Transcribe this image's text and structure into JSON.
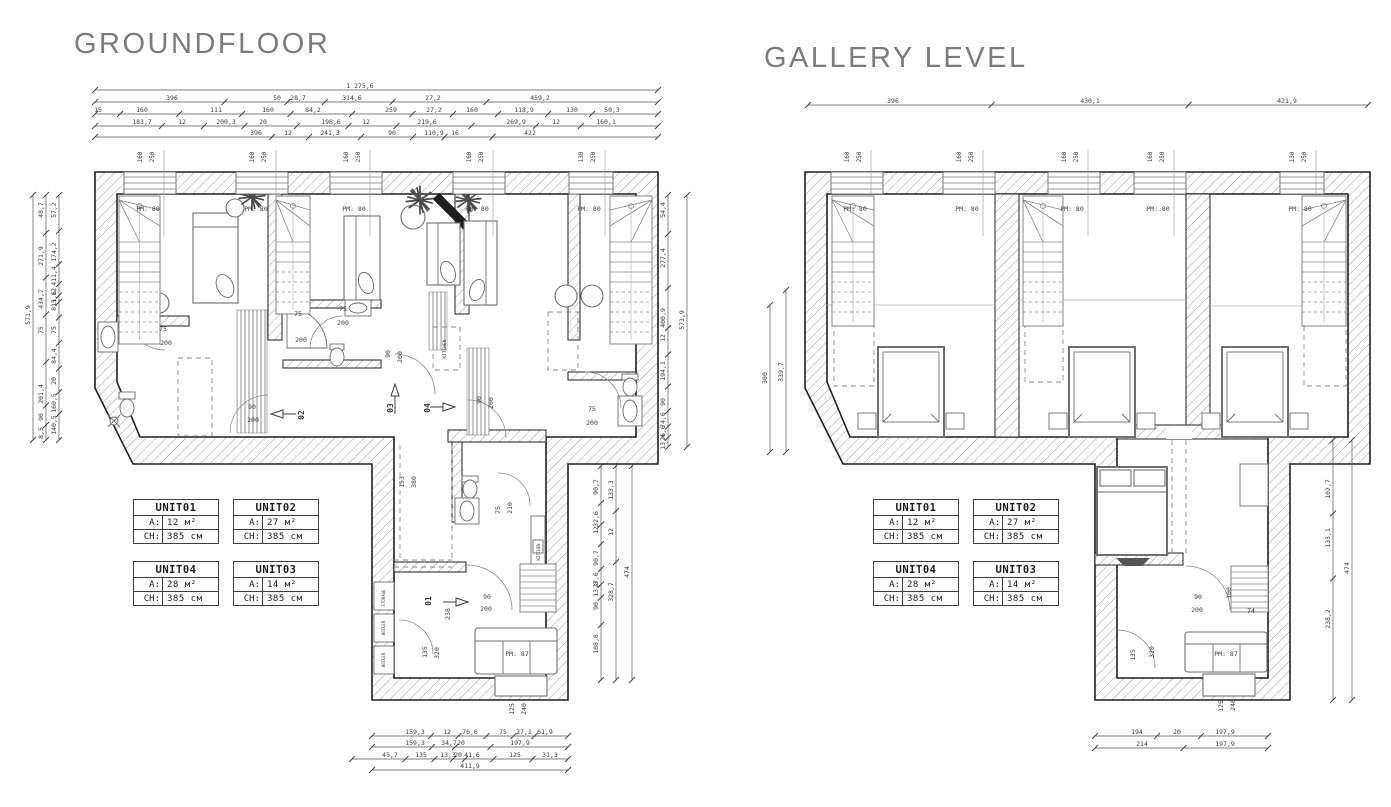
{
  "titles": {
    "groundfloor": "GROUNDFLOOR",
    "gallery": "GALLERY LEVEL"
  },
  "unit_table_labels": {
    "area": "A:",
    "ceiling": "CH:"
  },
  "units": [
    {
      "name": "UNIT01",
      "area": "12 м²",
      "ceiling_height": "385 см"
    },
    {
      "name": "UNIT02",
      "area": "27 м²",
      "ceiling_height": "385 см"
    },
    {
      "name": "UNIT04",
      "area": "28 м²",
      "ceiling_height": "385 см"
    },
    {
      "name": "UNIT03",
      "area": "14 м²",
      "ceiling_height": "385 см"
    }
  ],
  "groundfloor": {
    "dim_chains": [
      {
        "o": "h",
        "y": 90,
        "x1": 95,
        "x2": 658,
        "labels": [
          {
            "t": "1 275,6",
            "x": 360
          }
        ]
      },
      {
        "o": "h",
        "y": 102,
        "x1": 95,
        "x2": 658,
        "labels": [
          {
            "t": "396",
            "x": 172
          },
          {
            "t": "50",
            "x": 277
          },
          {
            "t": "28,7",
            "x": 298
          },
          {
            "t": "314,6",
            "x": 352
          },
          {
            "t": "27,2",
            "x": 433
          },
          {
            "t": "459,2",
            "x": 540
          }
        ]
      },
      {
        "o": "h",
        "y": 114,
        "x1": 95,
        "x2": 658,
        "labels": [
          {
            "t": "15",
            "x": 98
          },
          {
            "t": "160",
            "x": 142
          },
          {
            "t": "111",
            "x": 216
          },
          {
            "t": "160",
            "x": 268
          },
          {
            "t": "84,2",
            "x": 313
          },
          {
            "t": "259",
            "x": 391
          },
          {
            "t": "27,2",
            "x": 434
          },
          {
            "t": "160",
            "x": 472
          },
          {
            "t": "118,9",
            "x": 524
          },
          {
            "t": "130",
            "x": 572
          },
          {
            "t": "50,3",
            "x": 612
          }
        ]
      },
      {
        "o": "h",
        "y": 126,
        "x1": 95,
        "x2": 658,
        "labels": [
          {
            "t": "183,7",
            "x": 142
          },
          {
            "t": "12",
            "x": 182
          },
          {
            "t": "200,3",
            "x": 226
          },
          {
            "t": "20",
            "x": 263
          },
          {
            "t": "198,6",
            "x": 331
          },
          {
            "t": "12",
            "x": 366
          },
          {
            "t": "219,6",
            "x": 427
          },
          {
            "t": "269,9",
            "x": 516
          },
          {
            "t": "12",
            "x": 556
          },
          {
            "t": "160,1",
            "x": 606
          }
        ]
      },
      {
        "o": "h",
        "y": 137,
        "x1": 95,
        "x2": 658,
        "labels": [
          {
            "t": "396",
            "x": 256
          },
          {
            "t": "12",
            "x": 288
          },
          {
            "t": "241,3",
            "x": 330
          },
          {
            "t": "90",
            "x": 392
          },
          {
            "t": "110,9",
            "x": 434
          },
          {
            "t": "16",
            "x": 455
          },
          {
            "t": "422",
            "x": 530
          }
        ]
      },
      {
        "o": "h",
        "y": 736,
        "x1": 372,
        "x2": 568,
        "labels": [
          {
            "t": "159,3",
            "x": 415
          },
          {
            "t": "12",
            "x": 447
          },
          {
            "t": "76,6",
            "x": 470
          },
          {
            "t": "75",
            "x": 503
          },
          {
            "t": "27,1",
            "x": 524
          },
          {
            "t": "61,9",
            "x": 545
          }
        ]
      },
      {
        "o": "h",
        "y": 747,
        "x1": 372,
        "x2": 568,
        "labels": [
          {
            "t": "159,3",
            "x": 415
          },
          {
            "t": "34,7",
            "x": 449
          },
          {
            "t": "20",
            "x": 461
          },
          {
            "t": "197,9",
            "x": 520
          }
        ]
      },
      {
        "o": "h",
        "y": 759,
        "x1": 352,
        "x2": 568,
        "labels": [
          {
            "t": "45,7",
            "x": 390
          },
          {
            "t": "135",
            "x": 421
          },
          {
            "t": "13,3",
            "x": 448
          },
          {
            "t": "20",
            "x": 458
          },
          {
            "t": "41,6",
            "x": 472
          },
          {
            "t": "125",
            "x": 515
          },
          {
            "t": "31,3",
            "x": 550
          }
        ]
      },
      {
        "o": "h",
        "y": 770,
        "x1": 372,
        "x2": 568,
        "labels": [
          {
            "t": "411,9",
            "x": 470
          }
        ]
      },
      {
        "o": "v",
        "x": 33,
        "y1": 195,
        "y2": 440,
        "labels": [
          {
            "t": "571,9",
            "y": 315
          }
        ]
      },
      {
        "o": "v",
        "x": 46,
        "y1": 195,
        "y2": 440,
        "labels": [
          {
            "t": "48,7",
            "y": 210
          },
          {
            "t": "271,9",
            "y": 256
          },
          {
            "t": "434,7",
            "y": 299
          },
          {
            "t": "75",
            "y": 330
          },
          {
            "t": "201,4",
            "y": 394
          },
          {
            "t": "90",
            "y": 417
          },
          {
            "t": "8,5",
            "y": 433
          }
        ]
      },
      {
        "o": "v",
        "x": 59,
        "y1": 195,
        "y2": 440,
        "labels": [
          {
            "t": "57,2",
            "y": 210
          },
          {
            "t": "174,2",
            "y": 252
          },
          {
            "t": "411,4",
            "y": 276
          },
          {
            "t": "12",
            "y": 292
          },
          {
            "t": "11,6",
            "y": 299
          },
          {
            "t": "8,5",
            "y": 305
          },
          {
            "t": "75",
            "y": 330
          },
          {
            "t": "84,4",
            "y": 356
          },
          {
            "t": "20",
            "y": 381
          },
          {
            "t": "160,5",
            "y": 403
          },
          {
            "t": "140,5",
            "y": 425
          }
        ]
      },
      {
        "o": "v",
        "x": 668,
        "y1": 195,
        "y2": 447,
        "labels": [
          {
            "t": "54,4",
            "y": 210
          },
          {
            "t": "277,4",
            "y": 258
          },
          {
            "t": "400,9",
            "y": 318
          },
          {
            "t": "12",
            "y": 338
          },
          {
            "t": "194,1",
            "y": 371
          },
          {
            "t": "90",
            "y": 402
          },
          {
            "t": "74,6",
            "y": 420
          },
          {
            "t": "26,6",
            "y": 433
          },
          {
            "t": "13,4",
            "y": 442
          }
        ]
      },
      {
        "o": "v",
        "x": 687,
        "y1": 195,
        "y2": 447,
        "labels": [
          {
            "t": "571,9",
            "y": 320
          }
        ]
      },
      {
        "o": "v",
        "x": 601,
        "y1": 466,
        "y2": 680,
        "labels": [
          {
            "t": "90,7",
            "y": 487
          },
          {
            "t": "32,6",
            "y": 519
          },
          {
            "t": "12",
            "y": 530
          },
          {
            "t": "90,7",
            "y": 558
          },
          {
            "t": "27,6",
            "y": 580
          },
          {
            "t": "13,8",
            "y": 589
          },
          {
            "t": "90",
            "y": 606
          },
          {
            "t": "108,8",
            "y": 644
          }
        ]
      },
      {
        "o": "v",
        "x": 616,
        "y1": 466,
        "y2": 680,
        "labels": [
          {
            "t": "133,3",
            "y": 490
          },
          {
            "t": "12",
            "y": 532
          },
          {
            "t": "328,7",
            "y": 592
          }
        ]
      },
      {
        "o": "v",
        "x": 632,
        "y1": 466,
        "y2": 680,
        "labels": [
          {
            "t": "474",
            "y": 572
          }
        ]
      }
    ],
    "labels": [
      {
        "t": "160",
        "x": 142,
        "y": 157,
        "r": 1,
        "s": 6
      },
      {
        "t": "250",
        "x": 154,
        "y": 157,
        "r": 1,
        "s": 6
      },
      {
        "t": "160",
        "x": 254,
        "y": 157,
        "r": 1,
        "s": 6
      },
      {
        "t": "250",
        "x": 266,
        "y": 157,
        "r": 1,
        "s": 6
      },
      {
        "t": "160",
        "x": 348,
        "y": 157,
        "r": 1,
        "s": 6
      },
      {
        "t": "250",
        "x": 360,
        "y": 157,
        "r": 1,
        "s": 6
      },
      {
        "t": "160",
        "x": 471,
        "y": 157,
        "r": 1,
        "s": 6
      },
      {
        "t": "250",
        "x": 483,
        "y": 157,
        "r": 1,
        "s": 6
      },
      {
        "t": "130",
        "x": 583,
        "y": 157,
        "r": 1,
        "s": 6
      },
      {
        "t": "250",
        "x": 595,
        "y": 157,
        "r": 1,
        "s": 6
      },
      {
        "t": "PM: 80",
        "x": 148,
        "y": 211
      },
      {
        "t": "PM: 80",
        "x": 256,
        "y": 211
      },
      {
        "t": "PM: 80",
        "x": 354,
        "y": 211
      },
      {
        "t": "PM: 80",
        "x": 477,
        "y": 211
      },
      {
        "t": "PM: 80",
        "x": 589,
        "y": 211
      },
      {
        "t": "75",
        "x": 163,
        "y": 331
      },
      {
        "t": "200",
        "x": 166,
        "y": 345
      },
      {
        "t": "75",
        "x": 298,
        "y": 316
      },
      {
        "t": "200",
        "x": 301,
        "y": 342
      },
      {
        "t": "75",
        "x": 343,
        "y": 311
      },
      {
        "t": "200",
        "x": 343,
        "y": 325
      },
      {
        "t": "90",
        "x": 252,
        "y": 409
      },
      {
        "t": "200",
        "x": 253,
        "y": 422
      },
      {
        "t": "90",
        "x": 390,
        "y": 354,
        "r": 1
      },
      {
        "t": "200",
        "x": 402,
        "y": 357,
        "r": 1
      },
      {
        "t": "90",
        "x": 481,
        "y": 400,
        "r": 1
      },
      {
        "t": "200",
        "x": 493,
        "y": 403,
        "r": 1
      },
      {
        "t": "75",
        "x": 592,
        "y": 411
      },
      {
        "t": "200",
        "x": 592,
        "y": 425
      },
      {
        "t": "75",
        "x": 500,
        "y": 510,
        "r": 1
      },
      {
        "t": "210",
        "x": 512,
        "y": 508,
        "r": 1
      },
      {
        "t": "90",
        "x": 487,
        "y": 599
      },
      {
        "t": "200",
        "x": 486,
        "y": 611
      },
      {
        "t": "02",
        "x": 304,
        "y": 415,
        "r": 1,
        "b": 1,
        "s": 8
      },
      {
        "t": "03",
        "x": 393,
        "y": 408,
        "r": 1,
        "b": 1,
        "s": 8
      },
      {
        "t": "04",
        "x": 430,
        "y": 408,
        "r": 1,
        "b": 1,
        "s": 8
      },
      {
        "t": "01",
        "x": 431,
        "y": 601,
        "r": 1,
        "b": 1,
        "s": 8
      },
      {
        "t": "153",
        "x": 404,
        "y": 482,
        "r": 1
      },
      {
        "t": "380",
        "x": 416,
        "y": 482,
        "r": 1
      },
      {
        "t": "238",
        "x": 450,
        "y": 614,
        "r": 1
      },
      {
        "t": "135",
        "x": 427,
        "y": 652,
        "r": 1
      },
      {
        "t": "320",
        "x": 439,
        "y": 653,
        "r": 1
      },
      {
        "t": "125",
        "x": 514,
        "y": 709,
        "r": 1
      },
      {
        "t": "240",
        "x": 526,
        "y": 709,
        "r": 1
      },
      {
        "t": "STORAGE",
        "x": 385,
        "y": 598,
        "r": 1,
        "s": 4
      },
      {
        "t": "BOILER",
        "x": 385,
        "y": 628,
        "r": 1,
        "s": 4
      },
      {
        "t": "BOILER",
        "x": 385,
        "y": 660,
        "r": 1,
        "s": 4
      },
      {
        "t": "KITCHEN",
        "x": 446,
        "y": 349,
        "r": 1,
        "s": 4.5
      },
      {
        "t": "KITCHEN",
        "x": 540,
        "y": 552,
        "r": 1,
        "s": 4
      },
      {
        "t": "PM: 87",
        "x": 517,
        "y": 656
      }
    ]
  },
  "gallery": {
    "dim_chains": [
      {
        "o": "h",
        "y": 105,
        "x1": 808,
        "x2": 1368,
        "labels": [
          {
            "t": "396",
            "x": 893
          },
          {
            "t": "430,1",
            "x": 1090
          },
          {
            "t": "421,9",
            "x": 1287
          }
        ]
      },
      {
        "o": "h",
        "y": 736,
        "x1": 1095,
        "x2": 1268,
        "labels": [
          {
            "t": "194",
            "x": 1137
          },
          {
            "t": "20",
            "x": 1177
          },
          {
            "t": "197,9",
            "x": 1225
          }
        ]
      },
      {
        "o": "h",
        "y": 748,
        "x1": 1095,
        "x2": 1268,
        "labels": [
          {
            "t": "214",
            "x": 1142
          },
          {
            "t": "197,9",
            "x": 1225
          }
        ]
      },
      {
        "o": "v",
        "x": 770,
        "y1": 305,
        "y2": 452,
        "labels": [
          {
            "t": "300",
            "y": 378
          }
        ]
      },
      {
        "o": "v",
        "x": 786,
        "y1": 290,
        "y2": 452,
        "labels": [
          {
            "t": "339,7",
            "y": 372
          }
        ]
      },
      {
        "o": "v",
        "x": 1333,
        "y1": 440,
        "y2": 700,
        "labels": [
          {
            "t": "102,7",
            "y": 489
          },
          {
            "t": "133,1",
            "y": 538
          },
          {
            "t": "238,2",
            "y": 619
          }
        ]
      },
      {
        "o": "v",
        "x": 1352,
        "y1": 440,
        "y2": 700,
        "labels": [
          {
            "t": "474",
            "y": 568
          }
        ]
      }
    ],
    "labels": [
      {
        "t": "160",
        "x": 849,
        "y": 157,
        "r": 1,
        "s": 6
      },
      {
        "t": "250",
        "x": 861,
        "y": 157,
        "r": 1,
        "s": 6
      },
      {
        "t": "160",
        "x": 961,
        "y": 157,
        "r": 1,
        "s": 6
      },
      {
        "t": "250",
        "x": 973,
        "y": 157,
        "r": 1,
        "s": 6
      },
      {
        "t": "160",
        "x": 1066,
        "y": 157,
        "r": 1,
        "s": 6
      },
      {
        "t": "250",
        "x": 1078,
        "y": 157,
        "r": 1,
        "s": 6
      },
      {
        "t": "160",
        "x": 1152,
        "y": 157,
        "r": 1,
        "s": 6
      },
      {
        "t": "250",
        "x": 1164,
        "y": 157,
        "r": 1,
        "s": 6
      },
      {
        "t": "130",
        "x": 1294,
        "y": 157,
        "r": 1,
        "s": 6
      },
      {
        "t": "250",
        "x": 1306,
        "y": 157,
        "r": 1,
        "s": 6
      },
      {
        "t": "PM: 80",
        "x": 855,
        "y": 211
      },
      {
        "t": "PM: 80",
        "x": 967,
        "y": 211
      },
      {
        "t": "PM: 80",
        "x": 1072,
        "y": 211
      },
      {
        "t": "PM: 80",
        "x": 1158,
        "y": 211
      },
      {
        "t": "PM: 80",
        "x": 1300,
        "y": 211
      },
      {
        "t": "90",
        "x": 1198,
        "y": 599
      },
      {
        "t": "200",
        "x": 1197,
        "y": 612
      },
      {
        "t": "100",
        "x": 1231,
        "y": 593,
        "r": 1
      },
      {
        "t": "74",
        "x": 1251,
        "y": 613
      },
      {
        "t": "135",
        "x": 1135,
        "y": 655,
        "r": 1
      },
      {
        "t": "320",
        "x": 1154,
        "y": 652,
        "r": 1
      },
      {
        "t": "125",
        "x": 1223,
        "y": 706,
        "r": 1
      },
      {
        "t": "240",
        "x": 1235,
        "y": 705,
        "r": 1
      },
      {
        "t": "PM: 87",
        "x": 1226,
        "y": 656
      }
    ]
  }
}
